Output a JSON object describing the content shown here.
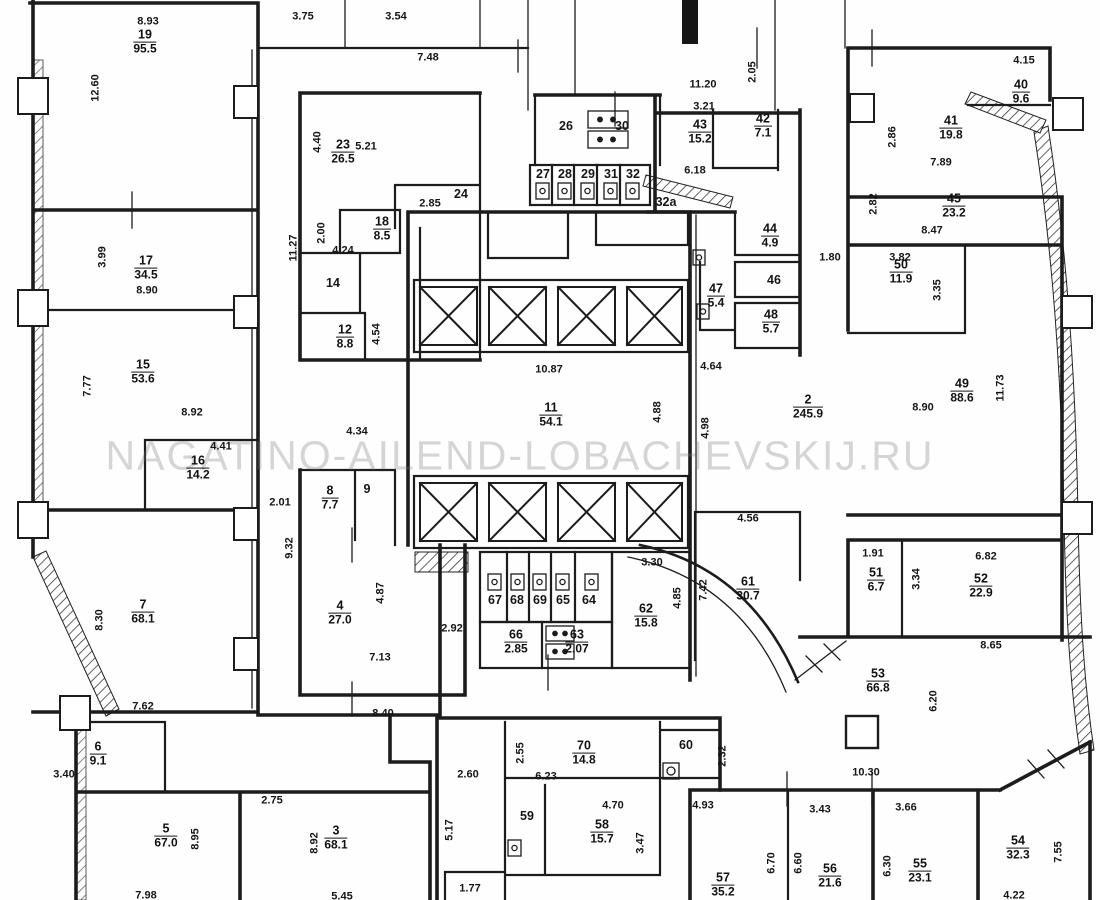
{
  "watermark": "NAGATINO-AILEND-LOBACHEVSKIJ.RU",
  "plan": {
    "rooms": [
      {
        "n": "19",
        "a": "95.5",
        "x": 145,
        "y": 42
      },
      {
        "n": "17",
        "a": "34.5",
        "x": 146,
        "y": 268
      },
      {
        "n": "15",
        "a": "53.6",
        "x": 143,
        "y": 372
      },
      {
        "n": "16",
        "a": "14.2",
        "x": 198,
        "y": 468
      },
      {
        "n": "7",
        "a": "68.1",
        "x": 143,
        "y": 612
      },
      {
        "n": "6",
        "a": "9.1",
        "x": 98,
        "y": 754
      },
      {
        "n": "5",
        "a": "67.0",
        "x": 166,
        "y": 836
      },
      {
        "n": "3",
        "a": "68.1",
        "x": 336,
        "y": 838
      },
      {
        "n": "23",
        "a": "26.5",
        "x": 343,
        "y": 152
      },
      {
        "n": "18",
        "a": "8.5",
        "x": 382,
        "y": 229
      },
      {
        "n": "12",
        "a": "8.8",
        "x": 345,
        "y": 337
      },
      {
        "n": "8",
        "a": "7.7",
        "x": 330,
        "y": 498
      },
      {
        "n": "4",
        "a": "27.0",
        "x": 340,
        "y": 613
      },
      {
        "n": "11",
        "a": "54.1",
        "x": 551,
        "y": 415
      },
      {
        "n": "43",
        "a": "15.2",
        "x": 700,
        "y": 132
      },
      {
        "n": "42",
        "a": "7.1",
        "x": 763,
        "y": 126
      },
      {
        "n": "44",
        "a": "4.9",
        "x": 770,
        "y": 236
      },
      {
        "n": "47",
        "a": "5.4",
        "x": 716,
        "y": 296
      },
      {
        "n": "48",
        "a": "5.7",
        "x": 771,
        "y": 322
      },
      {
        "n": "2",
        "a": "245.9",
        "x": 808,
        "y": 407
      },
      {
        "n": "61",
        "a": "30.7",
        "x": 748,
        "y": 589
      },
      {
        "n": "62",
        "a": "15.8",
        "x": 646,
        "y": 616
      },
      {
        "n": "66",
        "a": "2.85",
        "x": 516,
        "y": 642
      },
      {
        "n": "63",
        "a": "2.07",
        "x": 577,
        "y": 642
      },
      {
        "n": "40",
        "a": "9.6",
        "x": 1021,
        "y": 92
      },
      {
        "n": "41",
        "a": "19.8",
        "x": 951,
        "y": 128
      },
      {
        "n": "45",
        "a": "23.2",
        "x": 954,
        "y": 206
      },
      {
        "n": "50",
        "a": "11.9",
        "x": 901,
        "y": 272
      },
      {
        "n": "49",
        "a": "88.6",
        "x": 962,
        "y": 391
      },
      {
        "n": "51",
        "a": "6.7",
        "x": 876,
        "y": 580
      },
      {
        "n": "52",
        "a": "22.9",
        "x": 981,
        "y": 586
      },
      {
        "n": "53",
        "a": "66.8",
        "x": 878,
        "y": 681
      },
      {
        "n": "70",
        "a": "14.8",
        "x": 584,
        "y": 753
      },
      {
        "n": "58",
        "a": "15.7",
        "x": 602,
        "y": 832
      },
      {
        "n": "57",
        "a": "35.2",
        "x": 723,
        "y": 885
      },
      {
        "n": "56",
        "a": "21.6",
        "x": 830,
        "y": 876
      },
      {
        "n": "55",
        "a": "23.1",
        "x": 920,
        "y": 871
      },
      {
        "n": "54",
        "a": "32.3",
        "x": 1018,
        "y": 848
      }
    ],
    "texts": [
      {
        "t": "8.93",
        "x": 148,
        "y": 22
      },
      {
        "t": "12.60",
        "x": 96,
        "y": 88,
        "v": true
      },
      {
        "t": "3.75",
        "x": 303,
        "y": 17
      },
      {
        "t": "3.54",
        "x": 396,
        "y": 17
      },
      {
        "t": "7.48",
        "x": 428,
        "y": 58
      },
      {
        "t": "11.20",
        "x": 703,
        "y": 85
      },
      {
        "t": "2.05",
        "x": 753,
        "y": 72,
        "v": true
      },
      {
        "t": "3.21",
        "x": 704,
        "y": 107
      },
      {
        "t": "6.18",
        "x": 695,
        "y": 171
      },
      {
        "t": "32a",
        "x": 666,
        "y": 202,
        "k": "n"
      },
      {
        "t": "4.15",
        "x": 1024,
        "y": 61
      },
      {
        "t": "2.86",
        "x": 893,
        "y": 137,
        "v": true
      },
      {
        "t": "7.89",
        "x": 941,
        "y": 163
      },
      {
        "t": "2.82",
        "x": 874,
        "y": 204,
        "v": true
      },
      {
        "t": "8.47",
        "x": 932,
        "y": 231
      },
      {
        "t": "3.82",
        "x": 900,
        "y": 258
      },
      {
        "t": "3.35",
        "x": 938,
        "y": 290,
        "v": true
      },
      {
        "t": "1.80",
        "x": 830,
        "y": 258
      },
      {
        "t": "3.99",
        "x": 103,
        "y": 257,
        "v": true
      },
      {
        "t": "8.90",
        "x": 147,
        "y": 291
      },
      {
        "t": "4.40",
        "x": 318,
        "y": 142,
        "v": true
      },
      {
        "t": "5.21",
        "x": 366,
        "y": 147
      },
      {
        "t": "2.85",
        "x": 430,
        "y": 204
      },
      {
        "t": "2.00",
        "x": 322,
        "y": 233,
        "v": true
      },
      {
        "t": "4.24",
        "x": 343,
        "y": 251
      },
      {
        "t": "11.27",
        "x": 294,
        "y": 248,
        "v": true
      },
      {
        "t": "4.54",
        "x": 377,
        "y": 334,
        "v": true
      },
      {
        "t": "7.77",
        "x": 88,
        "y": 386,
        "v": true
      },
      {
        "t": "8.92",
        "x": 192,
        "y": 413
      },
      {
        "t": "4.41",
        "x": 221,
        "y": 447
      },
      {
        "t": "2.01",
        "x": 280,
        "y": 503
      },
      {
        "t": "9.32",
        "x": 290,
        "y": 548,
        "v": true
      },
      {
        "t": "10.87",
        "x": 549,
        "y": 370
      },
      {
        "t": "4.88",
        "x": 658,
        "y": 412,
        "v": true
      },
      {
        "t": "4.98",
        "x": 706,
        "y": 428,
        "v": true
      },
      {
        "t": "4.64",
        "x": 711,
        "y": 367
      },
      {
        "t": "8.90",
        "x": 923,
        "y": 408
      },
      {
        "t": "11.73",
        "x": 1001,
        "y": 388,
        "v": true
      },
      {
        "t": "4.34",
        "x": 357,
        "y": 432
      },
      {
        "t": "4.87",
        "x": 381,
        "y": 593,
        "v": true
      },
      {
        "t": "7.13",
        "x": 380,
        "y": 658
      },
      {
        "t": "2.92",
        "x": 452,
        "y": 629
      },
      {
        "t": "3.30",
        "x": 652,
        "y": 563
      },
      {
        "t": "4.85",
        "x": 678,
        "y": 598,
        "v": true
      },
      {
        "t": "7.42",
        "x": 704,
        "y": 590,
        "v": true
      },
      {
        "t": "4.56",
        "x": 748,
        "y": 519
      },
      {
        "t": "8.40",
        "x": 383,
        "y": 714
      },
      {
        "t": "7.62",
        "x": 143,
        "y": 707
      },
      {
        "t": "8.30",
        "x": 100,
        "y": 620,
        "v": true
      },
      {
        "t": "3.40",
        "x": 64,
        "y": 775
      },
      {
        "t": "8.95",
        "x": 196,
        "y": 839,
        "v": true
      },
      {
        "t": "7.98",
        "x": 146,
        "y": 896
      },
      {
        "t": "2.75",
        "x": 272,
        "y": 801
      },
      {
        "t": "8.92",
        "x": 315,
        "y": 843,
        "v": true
      },
      {
        "t": "5.45",
        "x": 342,
        "y": 897
      },
      {
        "t": "2.60",
        "x": 468,
        "y": 775
      },
      {
        "t": "5.17",
        "x": 450,
        "y": 830,
        "v": true
      },
      {
        "t": "2.55",
        "x": 521,
        "y": 753,
        "v": true
      },
      {
        "t": "6.23",
        "x": 546,
        "y": 777
      },
      {
        "t": "2.32",
        "x": 723,
        "y": 756,
        "v": true
      },
      {
        "t": "4.70",
        "x": 613,
        "y": 806
      },
      {
        "t": "3.47",
        "x": 641,
        "y": 843,
        "v": true
      },
      {
        "t": "1.77",
        "x": 470,
        "y": 889
      },
      {
        "t": "4.93",
        "x": 703,
        "y": 806
      },
      {
        "t": "6.70",
        "x": 772,
        "y": 863,
        "v": true
      },
      {
        "t": "6.60",
        "x": 799,
        "y": 863,
        "v": true
      },
      {
        "t": "3.43",
        "x": 820,
        "y": 810
      },
      {
        "t": "6.30",
        "x": 888,
        "y": 866,
        "v": true
      },
      {
        "t": "3.66",
        "x": 906,
        "y": 808
      },
      {
        "t": "7.55",
        "x": 1059,
        "y": 852,
        "v": true
      },
      {
        "t": "4.22",
        "x": 1014,
        "y": 896
      },
      {
        "t": "10.30",
        "x": 866,
        "y": 773
      },
      {
        "t": "6.20",
        "x": 934,
        "y": 701,
        "v": true
      },
      {
        "t": "8.65",
        "x": 991,
        "y": 646
      },
      {
        "t": "6.82",
        "x": 986,
        "y": 557
      },
      {
        "t": "1.91",
        "x": 873,
        "y": 554
      },
      {
        "t": "3.34",
        "x": 917,
        "y": 579,
        "v": true
      },
      {
        "t": "24",
        "x": 461,
        "y": 194,
        "k": "n"
      },
      {
        "t": "14",
        "x": 333,
        "y": 283,
        "k": "n"
      },
      {
        "t": "9",
        "x": 367,
        "y": 489,
        "k": "n"
      },
      {
        "t": "26",
        "x": 566,
        "y": 126,
        "k": "n"
      },
      {
        "t": "30",
        "x": 622,
        "y": 126,
        "k": "n"
      },
      {
        "t": "27",
        "x": 543,
        "y": 174,
        "k": "n"
      },
      {
        "t": "28",
        "x": 565,
        "y": 174,
        "k": "n"
      },
      {
        "t": "29",
        "x": 588,
        "y": 174,
        "k": "n"
      },
      {
        "t": "31",
        "x": 611,
        "y": 174,
        "k": "n"
      },
      {
        "t": "32",
        "x": 633,
        "y": 174,
        "k": "n"
      },
      {
        "t": "46",
        "x": 774,
        "y": 280,
        "k": "n"
      },
      {
        "t": "60",
        "x": 686,
        "y": 745,
        "k": "n"
      },
      {
        "t": "59",
        "x": 527,
        "y": 816,
        "k": "n"
      },
      {
        "t": "67",
        "x": 495,
        "y": 600,
        "k": "n"
      },
      {
        "t": "68",
        "x": 517,
        "y": 600,
        "k": "n"
      },
      {
        "t": "69",
        "x": 540,
        "y": 600,
        "k": "n"
      },
      {
        "t": "65",
        "x": 563,
        "y": 600,
        "k": "n"
      },
      {
        "t": "64",
        "x": 589,
        "y": 600,
        "k": "n"
      }
    ]
  }
}
